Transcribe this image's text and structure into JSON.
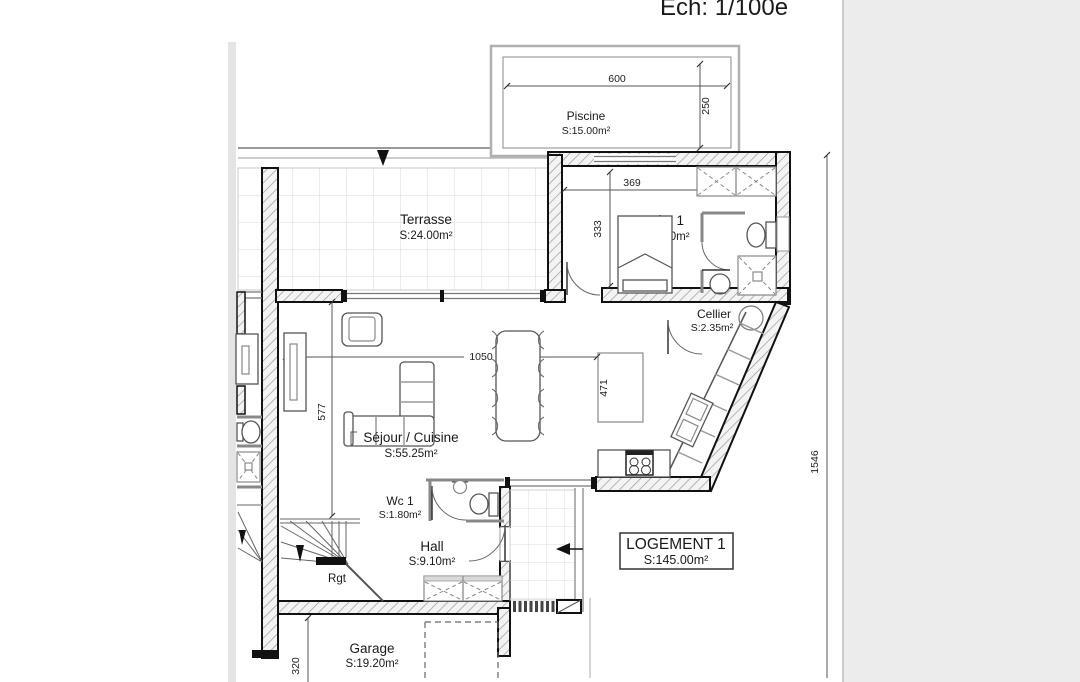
{
  "scale_label": "Ech: 1/100e",
  "colors": {
    "background": "#ffffff",
    "side_panel": "#ececec",
    "wall_line": "#111111",
    "tile_grid": "#d8d8d8",
    "dim_line": "#555555"
  },
  "plan": {
    "rooms": [
      {
        "id": "piscine",
        "name": "Piscine",
        "area": "S:15.00m²"
      },
      {
        "id": "terrasse",
        "name": "Terrasse",
        "area": "S:24.00m²"
      },
      {
        "id": "suite1",
        "name": "Suite 1",
        "area": "S:18.50m²"
      },
      {
        "id": "cellier",
        "name": "Cellier",
        "area": "S:2.35m²"
      },
      {
        "id": "sejour",
        "name": "Séjour / Cuisine",
        "area": "S:55.25m²"
      },
      {
        "id": "wc1",
        "name": "Wc 1",
        "area": "S:1.80m²"
      },
      {
        "id": "hall",
        "name": "Hall",
        "area": "S:9.10m²"
      },
      {
        "id": "garage",
        "name": "Garage",
        "area": "S:19.20m²"
      }
    ],
    "dimensions": {
      "pool_width": "600",
      "pool_depth": "250",
      "suite_width": "369",
      "suite_depth": "333",
      "living_width": "1050",
      "living_depth": "577",
      "island_length": "471",
      "plot_right": "1546",
      "garage_depth": "320"
    },
    "annotations": {
      "rangement": "Rgt"
    },
    "title_block": {
      "title": "LOGEMENT 1",
      "area": "S:145.00m²"
    }
  }
}
